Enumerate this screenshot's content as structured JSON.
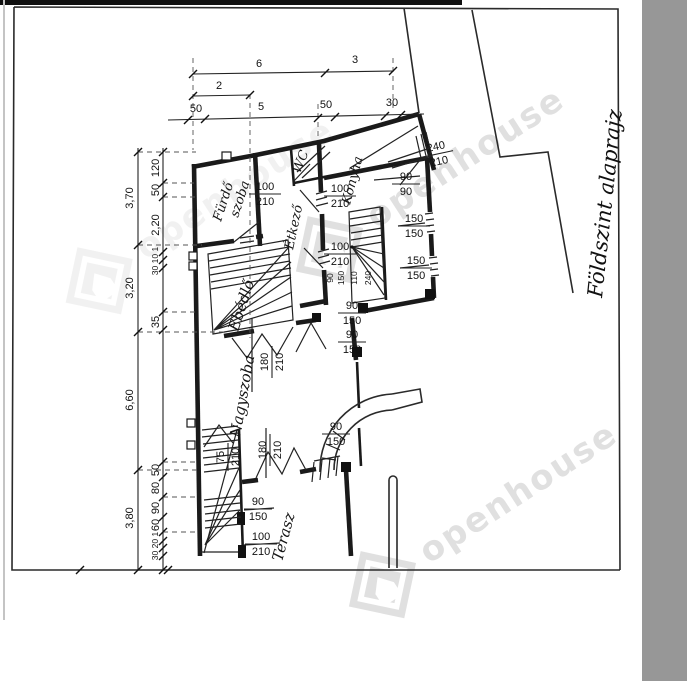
{
  "colors": {
    "paper": "#ffffff",
    "ink": "#1a1a1a",
    "scan_band": "#979797",
    "watermark": "#9a9a9a"
  },
  "sheet": {
    "title": "Földszint alaprajz"
  },
  "watermark": {
    "text": "openhouse"
  },
  "rooms": {
    "bathroom_line1": "Fürdő",
    "bathroom_line2": "szoba",
    "wc": "WC",
    "pantry": "Étkező",
    "kitchen": "Konyha",
    "dining": "Ebédlő",
    "living": "Nagyszoba",
    "terrace": "Terasz"
  },
  "dims": {
    "top": [
      {
        "v": "6"
      },
      {
        "v": "3"
      },
      {
        "v": "2"
      },
      {
        "v": "50"
      },
      {
        "v": "5"
      },
      {
        "v": "50"
      },
      {
        "v": "30"
      }
    ],
    "left_outer": [
      {
        "v": "3,70"
      },
      {
        "v": "3,20"
      },
      {
        "v": "6,60"
      },
      {
        "v": "3,80"
      }
    ],
    "left_inner": [
      {
        "v": "120"
      },
      {
        "v": "50"
      },
      {
        "v": "2,20"
      },
      {
        "v": "30 10 1"
      },
      {
        "v": "35"
      },
      {
        "v": "50"
      },
      {
        "v": "80"
      },
      {
        "v": "90"
      },
      {
        "v": "60"
      },
      {
        "v": "30 20 1"
      }
    ],
    "fracs": [
      {
        "w": "100",
        "h": "210"
      },
      {
        "w": "100",
        "h": "210"
      },
      {
        "w": "100",
        "h": "210"
      },
      {
        "w": "240",
        "h": "210"
      },
      {
        "w": "90",
        "h": "90"
      },
      {
        "w": "150",
        "h": "150"
      },
      {
        "w": "150",
        "h": "150"
      },
      {
        "w": "90",
        "h": "150"
      },
      {
        "w": "90",
        "h": "150"
      },
      {
        "w": "90",
        "h": "150"
      },
      {
        "w": "90",
        "h": "150"
      },
      {
        "w": "100",
        "h": "210"
      },
      {
        "w": "180",
        "h": "210"
      },
      {
        "w": "180",
        "h": "210"
      },
      {
        "w": "75",
        "h": "210"
      }
    ],
    "stair_chain": [
      {
        "v": "90"
      },
      {
        "v": "150"
      },
      {
        "v": "110"
      },
      {
        "v": "240"
      }
    ]
  }
}
